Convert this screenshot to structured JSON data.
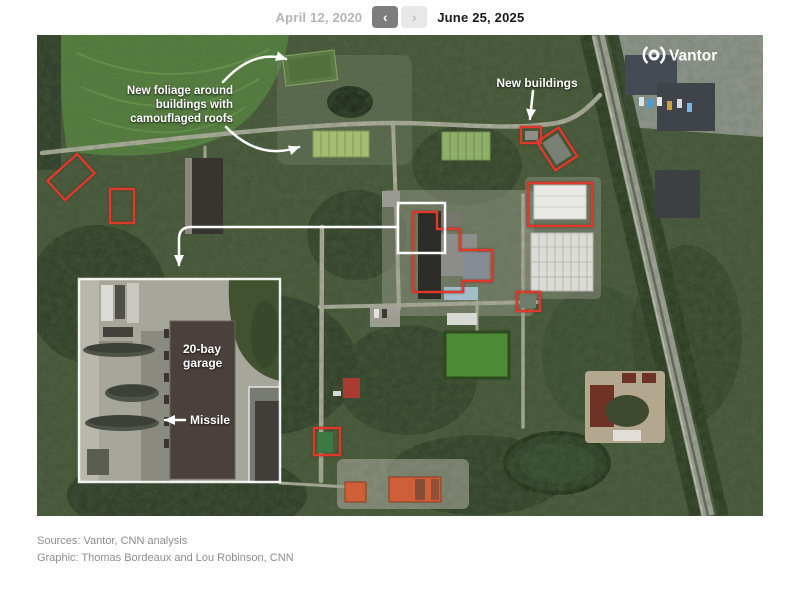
{
  "header": {
    "date_before": "April 12, 2020",
    "date_after": "June 25, 2025",
    "prev_icon": "‹",
    "next_icon": "›"
  },
  "watermark": {
    "brand": "Vantor"
  },
  "map_annotations": {
    "foliage_line1": "New foliage around",
    "foliage_line2": "buildings with",
    "foliage_line3": "camouflaged roofs",
    "new_buildings": "New buildings",
    "garage_line1": "20-bay",
    "garage_line2": "garage",
    "missile": "Missile"
  },
  "footer": {
    "sources": "Sources: Vantor, CNN analysis",
    "credit": "Graphic: Thomas Bordeaux and Lou Robinson, CNN"
  },
  "colors": {
    "annotation_red": "#dd3a2c",
    "annotation_white": "#ffffff",
    "date_active_text": "#1a1a1a",
    "date_inactive_text": "#b5b5b5",
    "footer_text": "#8e8e8e",
    "prev_button_bg": "#7d7d7d",
    "next_button_bg": "#e8e8e8",
    "forest_green": "#3e4e30",
    "field_green": "#4d7a36"
  }
}
